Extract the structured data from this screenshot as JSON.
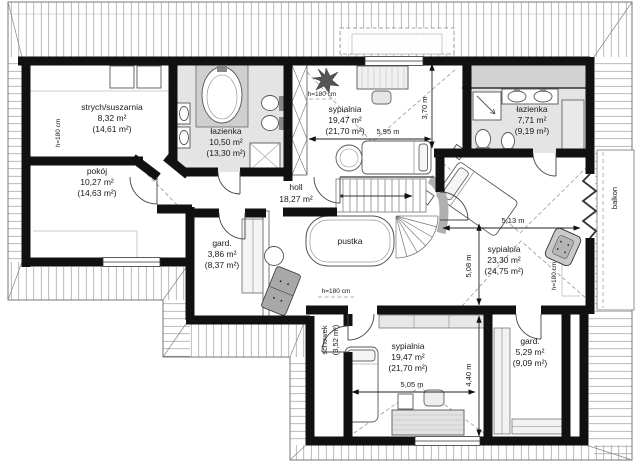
{
  "colors": {
    "wall": "#111111",
    "bath_floor": "#e4e4e4",
    "counter_gray": "#d2d2d2",
    "roof_line": "#8a8a8a",
    "text": "#1a1a1a"
  },
  "rooms": {
    "strych": {
      "name": "strych/suszarnia",
      "area": "8,32 m²",
      "area_alt": "(14,61 m²)"
    },
    "lazienka1": {
      "name": "łazienka",
      "area": "10,50 m²",
      "area_alt": "(13,30 m²)"
    },
    "sypialnia1": {
      "name": "sypialnia",
      "area": "19,47 m²",
      "area_alt": "(21,70 m²)"
    },
    "lazienka2": {
      "name": "łazienka",
      "area": "7,71 m²",
      "area_alt": "(9,19 m²)"
    },
    "pokoj": {
      "name": "pokój",
      "area": "10,27 m²",
      "area_alt": "(14,63 m²)"
    },
    "holl": {
      "name": "holl",
      "area": "18,27 m²"
    },
    "gard1": {
      "name": "gard.",
      "area": "3,86 m²",
      "area_alt": "(8,37 m²)"
    },
    "pustka": {
      "name": "pustka"
    },
    "sypialnia2": {
      "name": "sypialnia",
      "area": "23,30 m²",
      "area_alt": "(24,75 m²)"
    },
    "gard2": {
      "name": "gard.",
      "area": "5,29 m²",
      "area_alt": "(9,09 m²)"
    },
    "sypialnia3": {
      "name": "sypialnia",
      "area": "19,47 m²",
      "area_alt": "(21,70 m²)"
    },
    "schowek": {
      "name": "schowek",
      "area_alt": "(3,52 m²)"
    },
    "balkon": {
      "name": "balkon"
    }
  },
  "dimensions": {
    "sypialnia1_width": "5,95 m",
    "sypialnia1_depth": "3,70 m",
    "sypialnia2_width": "5,13 m",
    "sypialnia2_depth": "5,08 m",
    "sypialnia3_width": "5,05 m",
    "sypialnia3_depth": "4,40 m"
  },
  "height_labels": [
    "h=180 cm",
    "h=180 cm",
    "h=180 cm",
    "h=180 cm"
  ],
  "furniture_symbols": [
    "bathtub",
    "washbasin",
    "toilet",
    "bidet",
    "shower",
    "bed",
    "desk",
    "chair",
    "armchair",
    "sofa",
    "wardrobe",
    "potted-plant",
    "round-table",
    "staircase",
    "skylight"
  ]
}
